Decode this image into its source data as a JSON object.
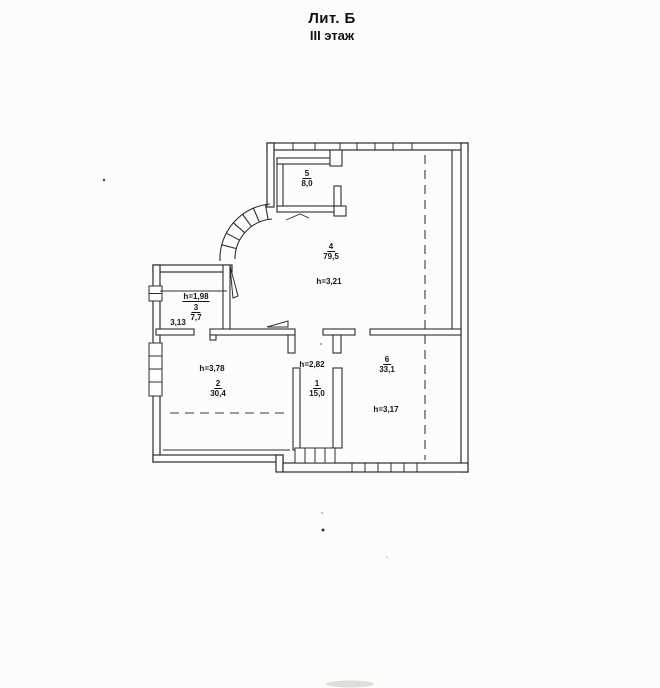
{
  "title": {
    "line1": "Лит. Б",
    "line2": "III этаж"
  },
  "rooms": {
    "r1": {
      "number": "1",
      "area": "15,0",
      "height": "h=2,82"
    },
    "r2": {
      "number": "2",
      "area": "30,4",
      "height": "h=3,78"
    },
    "r3": {
      "number": "3",
      "area": "7,7",
      "height": "h=1,98",
      "note": "3,13"
    },
    "r4": {
      "number": "4",
      "area": "79,5",
      "height": "h=3,21"
    },
    "r5": {
      "number": "5",
      "area": "8,0"
    },
    "r6": {
      "number": "6",
      "area": "33,1",
      "height": "h=3,17"
    }
  },
  "colors": {
    "line": "#2e2e2e",
    "paper": "#fcfcfb",
    "text": "#141414"
  }
}
